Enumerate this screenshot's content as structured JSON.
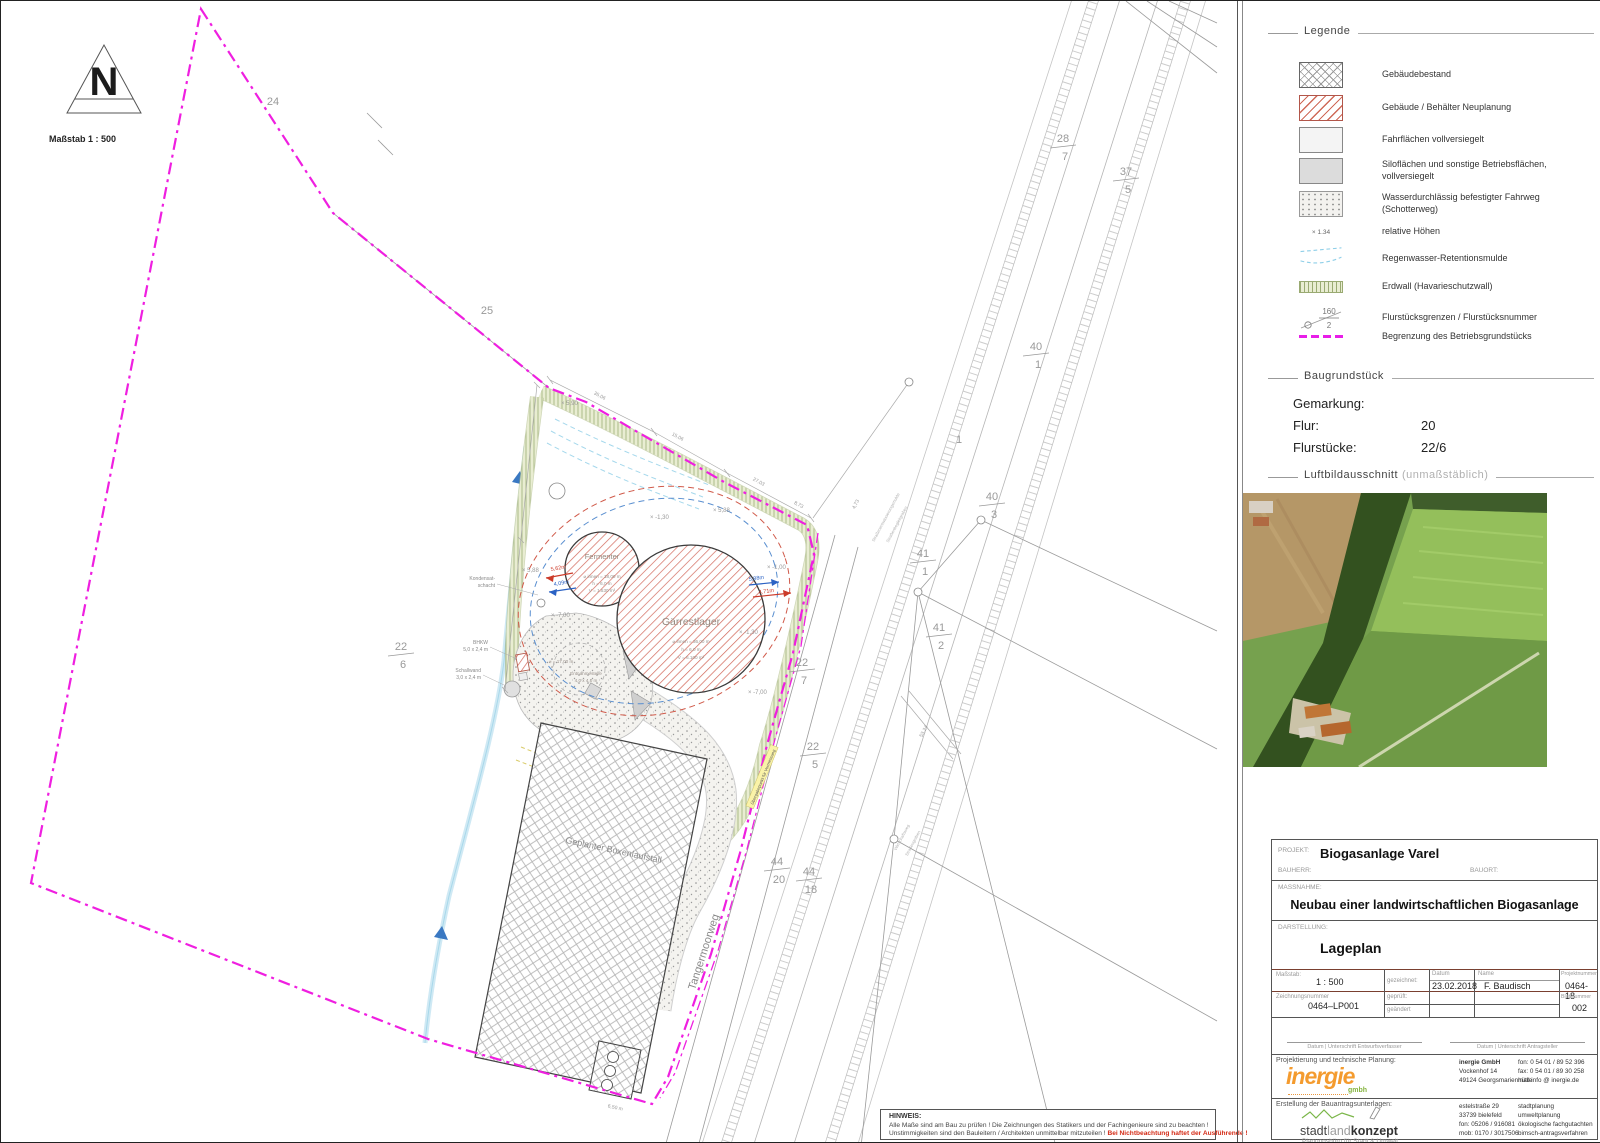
{
  "north": {
    "label": "Maßstab  1 : 500"
  },
  "legend": {
    "title": "Legende",
    "rel_height": "× 1.34",
    "flur_num": "160",
    "flur_den": "2",
    "items": [
      {
        "label": "Gebäudebestand"
      },
      {
        "label": "Gebäude / Behälter Neuplanung"
      },
      {
        "label": "Fahrflächen vollversiegelt"
      },
      {
        "label": "Siloflächen und sonstige Betriebsflächen, vollversiegelt"
      },
      {
        "label": "Wasserdurchlässig befestigter Fahrweg",
        "label2": "(Schotterweg)"
      },
      {
        "label": "relative Höhen"
      },
      {
        "label": "Regenwasser-Retentionsmulde"
      },
      {
        "label": "Erdwall (Havarieschutzwall)"
      },
      {
        "label": "Flurstücksgrenzen / Flurstücksnummer"
      },
      {
        "label": "Begrenzung des Betriebsgrundstücks"
      }
    ]
  },
  "bau": {
    "title": "Baugrundstück",
    "gemarkung_label": "Gemarkung:",
    "gemarkung_value": "",
    "flur_label": "Flur:",
    "flur_value": "20",
    "flurstuecke_label": "Flurstücke:",
    "flurstuecke_value": "22/6"
  },
  "luft": {
    "title": "Luftbildausschnitt",
    "subtitle": "(unmaßstäblich)"
  },
  "tb": {
    "projekt_label": "PROJEKT:",
    "projekt": "Biogasanlage Varel",
    "bauherr_label": "BAUHERR:",
    "bauort_label": "BAUORT:",
    "massnahme_label": "MASSNAHME:",
    "massnahme": "Neubau einer landwirtschaftlichen Biogasanlage",
    "darstellung_label": "DARSTELLUNG:",
    "darstellung": "Lageplan",
    "massstab_label": "Maßstab:",
    "massstab": "1 : 500",
    "zeichnung_label": "Zeichnungsnummer",
    "zeichnung": "0464–LP001",
    "gezeichnet": "gezeichnet:",
    "geprueft": "geprüft:",
    "geaendert": "geändert",
    "datum_label": "Datum",
    "datum": "23.02.2018",
    "name_label": "Name",
    "name": "F. Baudisch",
    "projektnr_label": "Projektnummer",
    "projektnr": "0464-18",
    "blattnr_label": "Blattnummer",
    "blattnr": "002"
  },
  "sig": {
    "left": "Datum  |  Unterschrift Entwurfsverfasser",
    "right": "Datum  |  Unterschrift Antragsteller"
  },
  "planung": {
    "section": "Projektierung und technische Planung:",
    "logo": "inergie",
    "logo_sub": "gmbh",
    "firm": "inergie GmbH",
    "a1": "Vockenhof 14",
    "a2": "49124 Georgsmarienhütte",
    "c1": "fon:  0 54 01 / 89 52 396",
    "c2": "fax:  0 54 01 / 89 30 258",
    "c3": "mail:info @ inergie.de"
  },
  "erstellung": {
    "section": "Erstellung der Bauantragsunterlagen:",
    "logo1": "stadt",
    "logo2": "land",
    "logo3": "konzept",
    "tagline": "Planungsbüro für Stadt & Umwelt",
    "a1": "estelstraße 29",
    "a2": "33739 bielefeld",
    "a3": "fon: 05206 / 916081",
    "a4": "mob: 0170 / 3017506",
    "s1": "stadtplanung",
    "s2": "umweltplanung",
    "s3": "ökologische fachgutachten",
    "s4": "bimsch-antragsverfahren"
  },
  "hinweis": {
    "title": "HINWEIS:",
    "line1": "Alle Maße sind am Bau zu prüfen !  Die Zeichnungen des Statikers und der Fachingenieure sind zu beachten !",
    "line2": "Unstimmigkeiten sind den Bauleitern / Architekten unmittelbar mitzuteilen !",
    "line2_red": "Bei Nichtbeachtung haftet der Ausführende !"
  },
  "plan": {
    "street": "Tangermoorweg",
    "stall": "Geplanter Boxenlaufstall",
    "fermenter": {
      "t": "Fermenter",
      "d": "⌀ innen = 18,00 m",
      "h": "h = 6,0 m",
      "v": "V = 1.530 m³"
    },
    "gaerrest": {
      "t": "Gärrestlager",
      "d": "⌀ innen = 36,00 m",
      "h": "h = 6,0 m",
      "v": "V = 6.100 m³"
    },
    "bhkw1": "BHKW",
    "bhkw2": "5,0 x 2,4 m",
    "schall1": "Schallwand",
    "schall2": "3,0 x 2,4 m",
    "kond1": "Kondensat-",
    "kond2": "schacht",
    "entnahme_d": "⌀ = 17,00 m",
    "entnahme1": "Entnahmestelle",
    "entnahme2": "4,0 x 4,0 m",
    "uebergabe": "Übergabepunkt für Vermessung",
    "arrows": {
      "lr": "5,62m",
      "lb": "4,09m",
      "rb": "5,88m",
      "rr": "4,71m"
    },
    "parcels": [
      {
        "num": "24"
      },
      {
        "num": "25"
      },
      {
        "num": "28",
        "den": "7"
      },
      {
        "num": "37",
        "den": "5"
      },
      {
        "num": "40",
        "den": "1"
      },
      {
        "num": "40",
        "den": "3"
      },
      {
        "num": "41",
        "den": "1"
      },
      {
        "num": "41",
        "den": "2"
      },
      {
        "num": "22",
        "den": "6"
      },
      {
        "num": "22",
        "den": "7"
      },
      {
        "num": "22",
        "den": "5"
      },
      {
        "num": "44",
        "den": "20"
      },
      {
        "num": "44",
        "den": "18"
      },
      {
        "num": "1"
      }
    ],
    "marks": [
      "× 5,90",
      "× 5,88",
      "× 5,88",
      "× -1,30",
      "× -7,00",
      "× -7,00",
      "× -1,00",
      "× -1,30"
    ],
    "dims": [
      "35,06",
      "15,06",
      "27,03",
      "8,73",
      "4,73",
      "53,24",
      "6,50 m"
    ],
    "road_labels": [
      "Straßenentwässerungsmulde",
      "Straßenbegleitgraben",
      "Wirtschaftsweg",
      "Straßengraben"
    ]
  }
}
